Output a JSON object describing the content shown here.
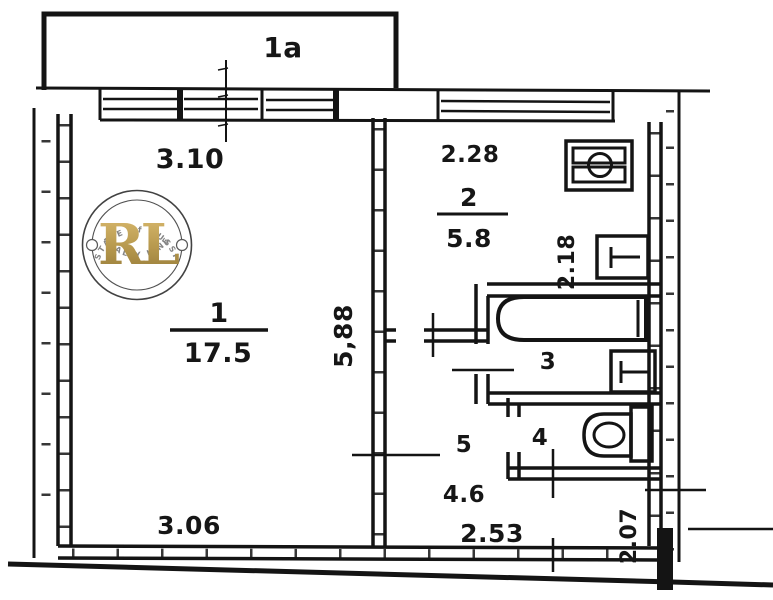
{
  "plan": {
    "balcony_label": "1a",
    "rooms": [
      {
        "number": "1",
        "area": "17.5"
      },
      {
        "number": "2",
        "area": "5.8"
      },
      {
        "number": "3"
      },
      {
        "number": "4"
      },
      {
        "number": "5",
        "area": "4.6"
      }
    ],
    "dimensions": {
      "room1_width_top": "3.10",
      "room1_width_bottom": "3.06",
      "room1_depth": "5,88",
      "kitchen_width": "2.28",
      "kitchen_depth": "2.18",
      "hall_width": "2.53",
      "entry_depth": "2.07"
    },
    "fixtures": [
      "stove",
      "kitchen-sink",
      "bathtub",
      "washbasin",
      "toilet"
    ]
  },
  "watermark": {
    "monogram": "RL",
    "arc_top": "ESTATE of RUSSIA",
    "arc_bottom": "REALTY LINE"
  },
  "colors": {
    "ink": "#141414",
    "watermark_gold": "#b9964a",
    "watermark_ring": "#333333",
    "watermark_text": "#7a7a7a",
    "background": "#ffffff"
  }
}
